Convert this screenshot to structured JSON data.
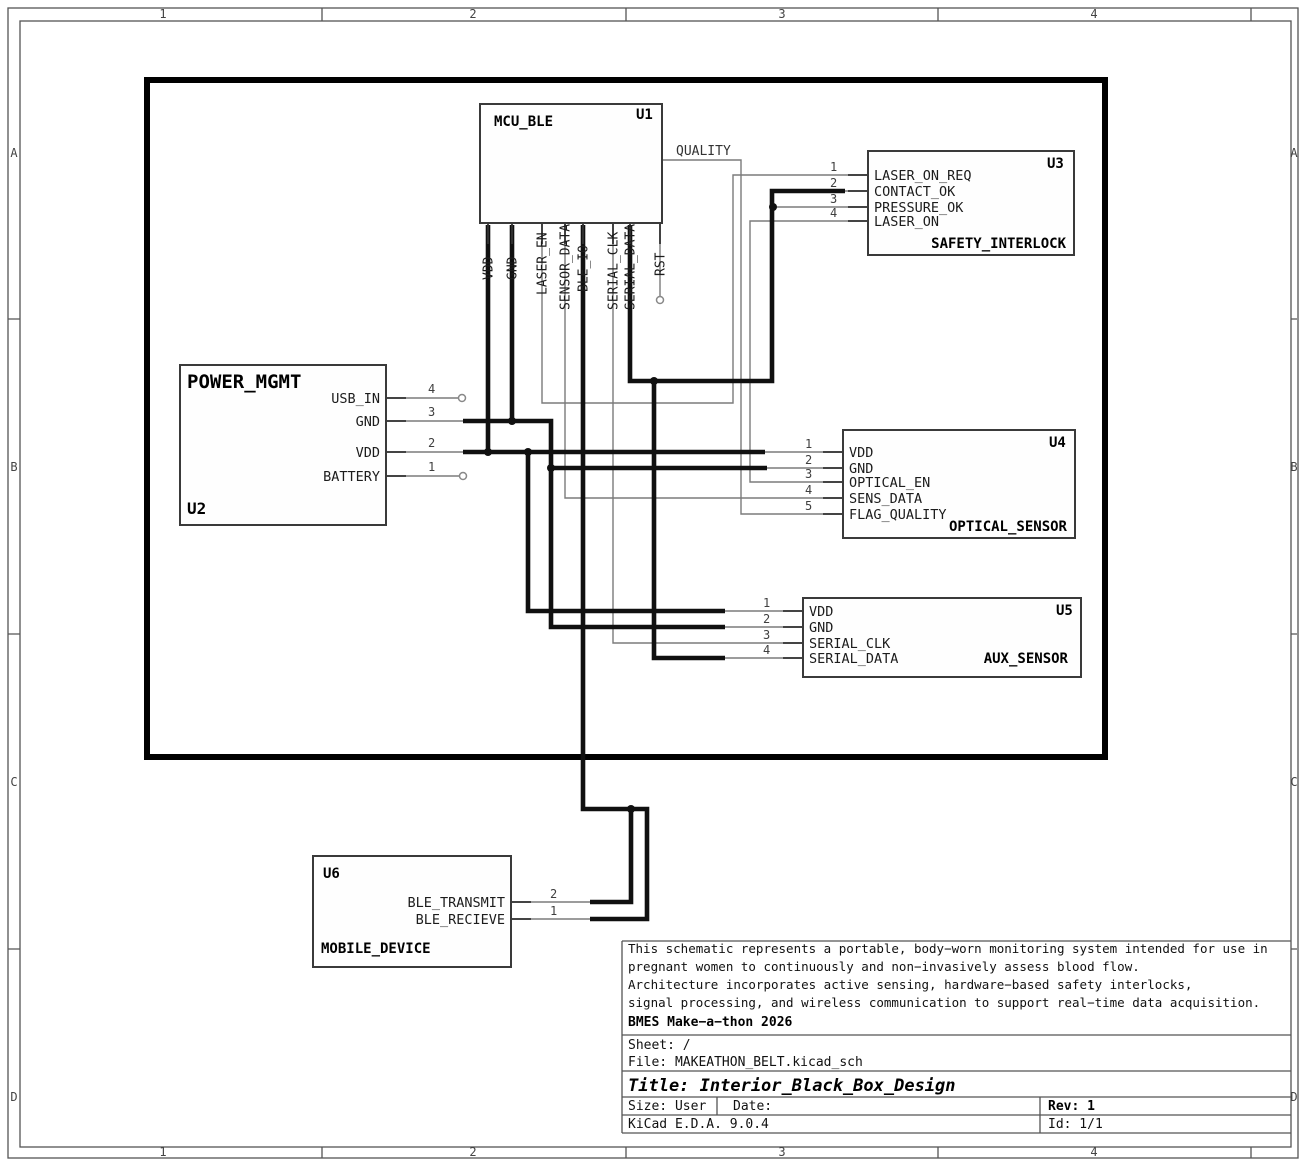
{
  "sheet": {
    "frame": {
      "columns": [
        "1",
        "2",
        "3",
        "4"
      ],
      "rows": [
        "A",
        "B",
        "C",
        "D"
      ]
    },
    "title_block": {
      "comment_lines": [
        "This schematic represents a portable, body−worn monitoring system intended for use in",
        "pregnant women to continuously and non−invasively assess blood flow.",
        "Architecture incorporates active sensing, hardware−based safety interlocks,",
        "signal processing, and wireless communication to support real−time data acquisition."
      ],
      "project": "BMES Make−a−thon 2026",
      "sheet": "Sheet: /",
      "file": "File: MAKEATHON_BELT.kicad_sch",
      "title": "Title: Interior_Black_Box_Design",
      "size": "Size: User",
      "date": "Date:",
      "rev": "Rev: 1",
      "tool": "KiCad E.D.A. 9.0.4",
      "id": "Id: 1/1"
    }
  },
  "net_labels": {
    "quality": "QUALITY"
  },
  "components": {
    "u1": {
      "ref": "U1",
      "value": "MCU_BLE",
      "pins": [
        {
          "name": "VDD"
        },
        {
          "name": "GND"
        },
        {
          "name": "LASER_EN"
        },
        {
          "name": "SENSOR_DATA"
        },
        {
          "name": "BLE_IO"
        },
        {
          "name": "SERIAL_CLK"
        },
        {
          "name": "SERIAL_DATA"
        },
        {
          "name": "RST"
        }
      ]
    },
    "u2": {
      "ref": "U2",
      "value": "POWER_MGMT",
      "pins": [
        {
          "num": "4",
          "name": "USB_IN"
        },
        {
          "num": "3",
          "name": "GND"
        },
        {
          "num": "2",
          "name": "VDD"
        },
        {
          "num": "1",
          "name": "BATTERY"
        }
      ]
    },
    "u3": {
      "ref": "U3",
      "value": "SAFETY_INTERLOCK",
      "pins": [
        {
          "num": "1",
          "name": "LASER_ON_REQ"
        },
        {
          "num": "2",
          "name": "CONTACT_OK"
        },
        {
          "num": "3",
          "name": "PRESSURE_OK"
        },
        {
          "num": "4",
          "name": "LASER_ON"
        }
      ]
    },
    "u4": {
      "ref": "U4",
      "value": "OPTICAL_SENSOR",
      "pins": [
        {
          "num": "1",
          "name": "VDD"
        },
        {
          "num": "2",
          "name": "GND"
        },
        {
          "num": "3",
          "name": "OPTICAL_EN"
        },
        {
          "num": "4",
          "name": "SENS_DATA"
        },
        {
          "num": "5",
          "name": "FLAG_QUALITY"
        }
      ]
    },
    "u5": {
      "ref": "U5",
      "value": "AUX_SENSOR",
      "pins": [
        {
          "num": "1",
          "name": "VDD"
        },
        {
          "num": "2",
          "name": "GND"
        },
        {
          "num": "3",
          "name": "SERIAL_CLK"
        },
        {
          "num": "4",
          "name": "SERIAL_DATA"
        }
      ]
    },
    "u6": {
      "ref": "U6",
      "value": "MOBILE_DEVICE",
      "pins": [
        {
          "num": "2",
          "name": "BLE_TRANSMIT"
        },
        {
          "num": "1",
          "name": "BLE_RECIEVE"
        }
      ]
    }
  },
  "colors": {
    "wire_thin": "#7b7b7b",
    "wire_thick": "#101010",
    "component_outline": "#3a3a3a",
    "black_box_outline": "#000000",
    "frame_line": "#555555"
  }
}
